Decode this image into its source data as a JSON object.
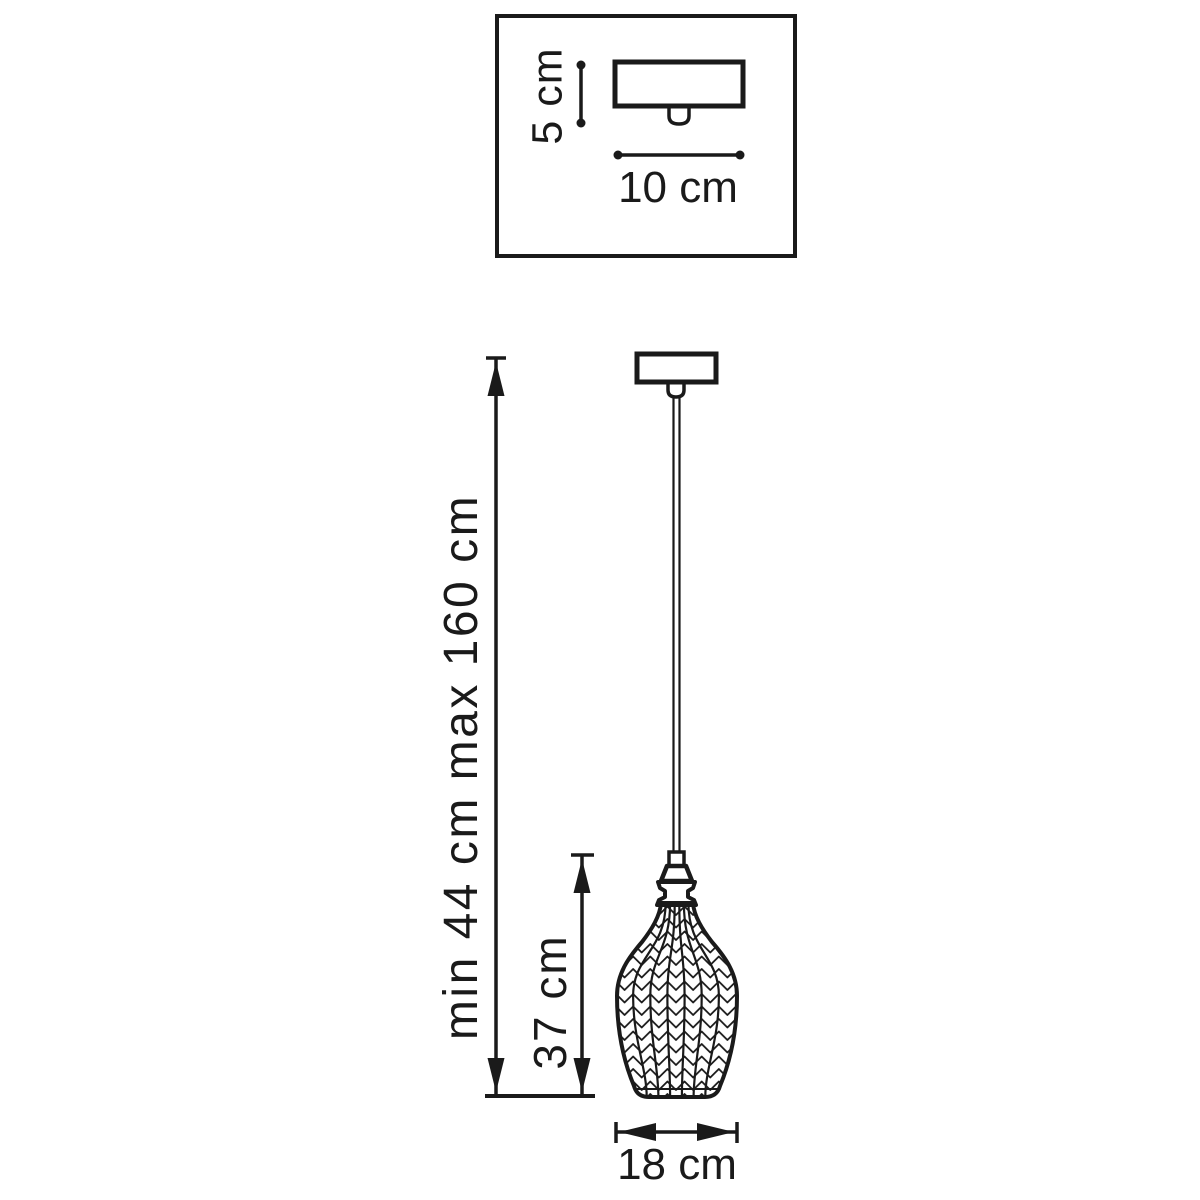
{
  "page": {
    "background": "#ffffff",
    "line_color": "#1a1a1a",
    "drawing_type": "pendant-lamp-dimension-diagram"
  },
  "canopy_inset": {
    "height_label": "5 cm",
    "width_label": "10 cm"
  },
  "pendant_view": {
    "suspension_height_label": "min 44 cm max 160 cm",
    "shade_height_label": "37 cm",
    "shade_diameter_label": "18 cm"
  }
}
